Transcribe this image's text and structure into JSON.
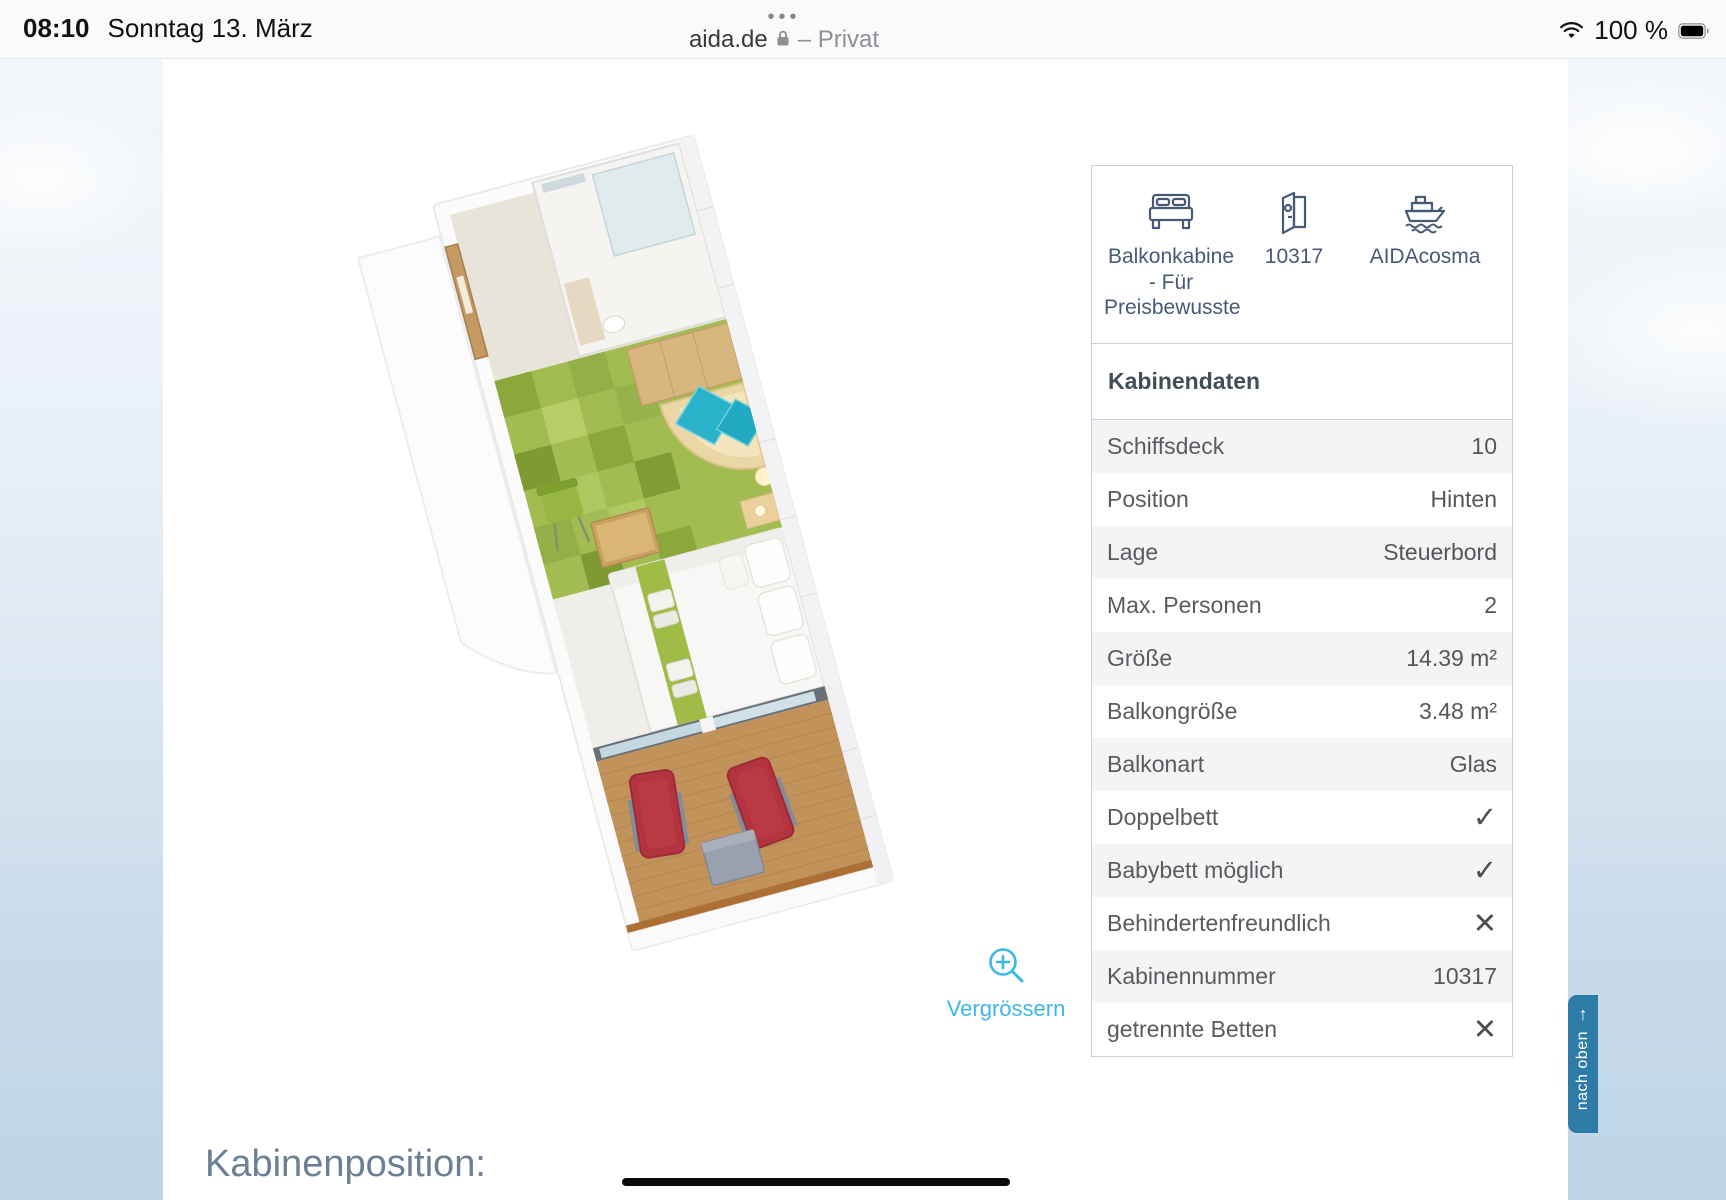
{
  "status_bar": {
    "time": "08:10",
    "date": "Sonntag 13. März",
    "battery": "100 %",
    "icons": [
      "wifi-icon",
      "battery-icon"
    ]
  },
  "browser": {
    "tab_dots": "•••",
    "domain": "aida.de",
    "privacy": "– Privat",
    "icons": [
      "lock-icon"
    ]
  },
  "cabin_card": {
    "items": [
      {
        "icon": "bed-icon",
        "label": "Balkonkabine - Für Preisbewusste"
      },
      {
        "icon": "door-icon",
        "label": "10317"
      },
      {
        "icon": "ship-icon",
        "label": "AIDAcosma"
      }
    ]
  },
  "cabin_data": {
    "title": "Kabinendaten",
    "rows": [
      {
        "label": "Schiffsdeck",
        "value": "10"
      },
      {
        "label": "Position",
        "value": "Hinten"
      },
      {
        "label": "Lage",
        "value": "Steuerbord"
      },
      {
        "label": "Max. Personen",
        "value": "2"
      },
      {
        "label": "Größe",
        "value": "14.39 m²"
      },
      {
        "label": "Balkongröße",
        "value": "3.48 m²"
      },
      {
        "label": "Balkonart",
        "value": "Glas"
      },
      {
        "label": "Doppelbett",
        "value": "✓"
      },
      {
        "label": "Babybett möglich",
        "value": "✓"
      },
      {
        "label": "Behindertenfreundlich",
        "value": "✕"
      },
      {
        "label": "Kabinennummer",
        "value": "10317"
      },
      {
        "label": "getrennte Betten",
        "value": "✕"
      }
    ]
  },
  "zoom_link": {
    "label": "Vergrössern",
    "icon": "magnifier-plus-icon"
  },
  "section_heading": "Kabinenposition:",
  "back_to_top": {
    "label": "nach oben",
    "arrow": "↑"
  },
  "colors": {
    "accent_blue": "#3fb6e8",
    "slate_icon": "#465a78",
    "back_to_top_bg": "#2e7ba7"
  }
}
